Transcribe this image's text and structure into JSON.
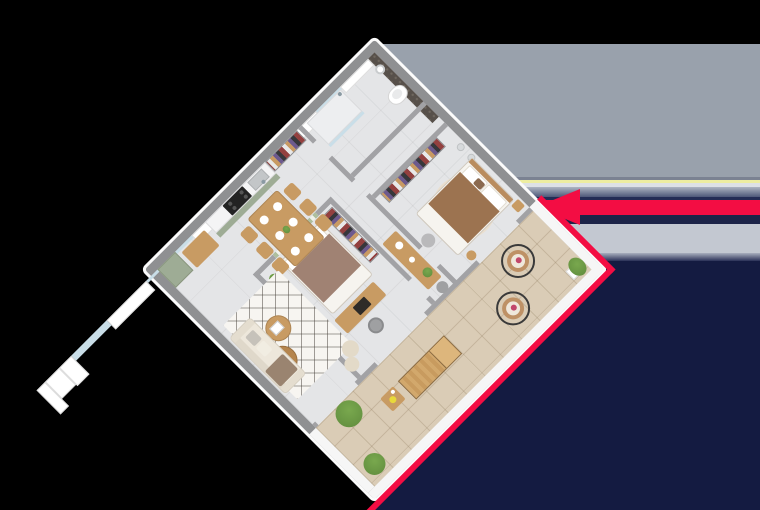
{
  "scene": {
    "type": "3d-floorplan-isometric-render",
    "description": "Top-down axonometric 3D render of a two-bedroom apartment with terrace",
    "view_rotation_deg": 45
  },
  "colors": {
    "bg": "#000000",
    "navy": "#141B41",
    "red": "#F30D43",
    "wall_ext": "#8F9092",
    "wall_int": "#A2A2A5",
    "wall_cap_white": "#F6F6F6",
    "white_face": "#FBFBFB",
    "floor": "#E4E5E7",
    "terrace": "#DACCB6",
    "kitchen_green": "#9EAC95",
    "wood": "#C89B63",
    "accent_dark": "#57504A",
    "accent_dot": "#6F675E",
    "pattern_green": "#AEBF9E",
    "bed1_blanket": "#9C7350",
    "bed2_blanket": "#A08273",
    "linen": "#F6F4EF",
    "sofa": "#EDE7DB",
    "rug": "#F7F5F1",
    "plant": "#79A84E",
    "plant_dark": "#5E8A3C",
    "glass": "#C9DEE8",
    "basket_tan": "#BE9166",
    "frame_black": "#3A3A3A",
    "yellow_flower": "#E8D93A"
  },
  "background": {
    "top_area": "black",
    "right_bands": [
      {
        "name": "slate-gray-panel",
        "color": "#99A1AC",
        "from": 44,
        "to": 177
      },
      {
        "name": "dark-edge-line",
        "color": "#7B8292",
        "from": 177,
        "to": 180
      },
      {
        "name": "yellow-stripe",
        "color": "#EDEDA1",
        "from": 180,
        "to": 183
      },
      {
        "name": "white-stripe",
        "color": "#DDE1E6",
        "from": 183,
        "to": 187
      },
      {
        "name": "slate-fade",
        "color": "linear-gradient(#AEB5C2,#4D5879)",
        "from": 187,
        "to": 197
      },
      {
        "name": "navy-line",
        "color": "#232C55",
        "from": 197,
        "to": 200
      },
      {
        "name": "red-arrow-band",
        "color": "#F30D43",
        "from": 200,
        "to": 215
      },
      {
        "name": "navy-line-2",
        "color": "#1C2448",
        "from": 215,
        "to": 224
      },
      {
        "name": "light-gray-band",
        "color": "#C3C8D1",
        "from": 224,
        "to": 253
      },
      {
        "name": "gray-navy-fade",
        "color": "linear-gradient(#A9AFBE,#2A3158)",
        "from": 253,
        "to": 261
      },
      {
        "name": "navy-field",
        "color": "#141B41",
        "from": 261,
        "to": 510
      }
    ]
  },
  "entrance_arrow": {
    "shape": "arrow",
    "direction": "left",
    "color": "#F30D43"
  },
  "wardrobe_clothes_palette": [
    "#93403F",
    "#37373B",
    "#6D5A8E",
    "#C89A63",
    "#E8E8E8"
  ],
  "rooms": [
    {
      "id": "bathroom",
      "features": [
        "shower",
        "glass-partition",
        "toilet",
        "white-cabinet"
      ]
    },
    {
      "id": "utility-nook",
      "features": [
        "white-cabinet"
      ]
    },
    {
      "id": "bedroom-1",
      "features": [
        "double-bed",
        "dark-accent-wall",
        "open-wardrobe",
        "vanity-two-sinks",
        "round-rug",
        "bedside-table",
        "pouf"
      ]
    },
    {
      "id": "hallway",
      "features": [
        "console-table",
        "plant",
        "pouf",
        "entry-closet"
      ]
    },
    {
      "id": "bedroom-2",
      "features": [
        "double-bed",
        "patterned-headboard-wall",
        "open-wardrobe",
        "desk",
        "laptop",
        "desk-chair",
        "plant"
      ]
    },
    {
      "id": "kitchen",
      "features": [
        "green-cabinets",
        "cooktop",
        "sink",
        "tall-corner-unit",
        "window"
      ]
    },
    {
      "id": "dining-area",
      "features": [
        "dining-table",
        "six-chairs",
        "plates",
        "centerpiece",
        "sideboard"
      ]
    },
    {
      "id": "living-room",
      "features": [
        "sofa",
        "lattice-rug",
        "two-coffee-tables",
        "two-ottomans",
        "sliding-glass-door"
      ]
    },
    {
      "id": "terrace",
      "features": [
        "tile-floor",
        "two-hanging-egg-chairs",
        "sun-lounger",
        "side-table",
        "potted-plants",
        "white-parapet"
      ]
    }
  ]
}
